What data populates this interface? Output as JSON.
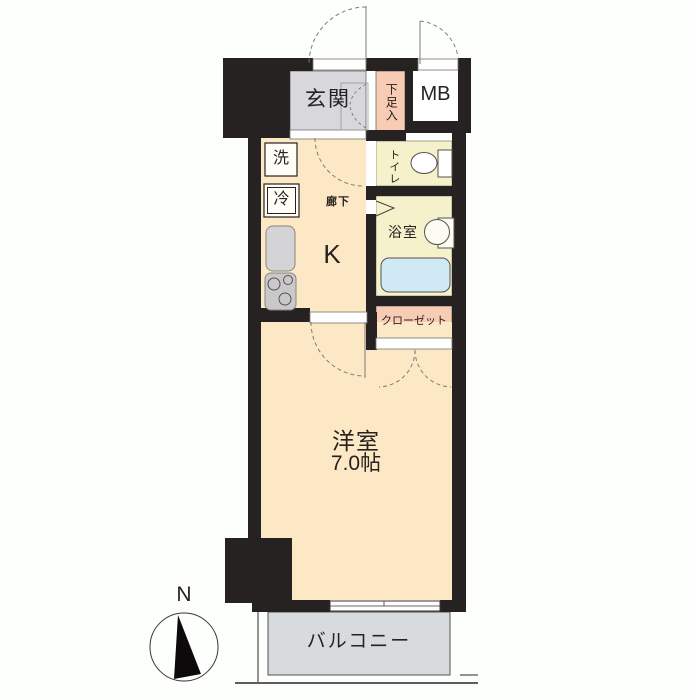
{
  "plan": {
    "type": "japanese-apartment-floorplan",
    "rooms": {
      "genkan": {
        "label": "玄関"
      },
      "shoe_box": {
        "label": "下足入"
      },
      "meter_box": {
        "label": "MB"
      },
      "washer": {
        "label": "洗"
      },
      "fridge": {
        "label": "冷"
      },
      "hallway": {
        "label": "廊下"
      },
      "kitchen": {
        "label": "K"
      },
      "toilet": {
        "label": "トイレ"
      },
      "bathroom": {
        "label": "浴室"
      },
      "closet": {
        "label": "クローゼット"
      },
      "western_room": {
        "label": "洋室",
        "size": "7.0帖"
      },
      "balcony": {
        "label": "バルコニー"
      }
    },
    "compass": {
      "north_label": "N"
    },
    "colors": {
      "wall": "#262222",
      "main_floor": "#fce8c5",
      "genkan_floor": "#d8d8dc",
      "storage_pink": "#f8ccb4",
      "wet_area": "#f5f1cb",
      "bathtub": "#cfe9f5",
      "balcony_gray": "#d7dbde"
    }
  }
}
